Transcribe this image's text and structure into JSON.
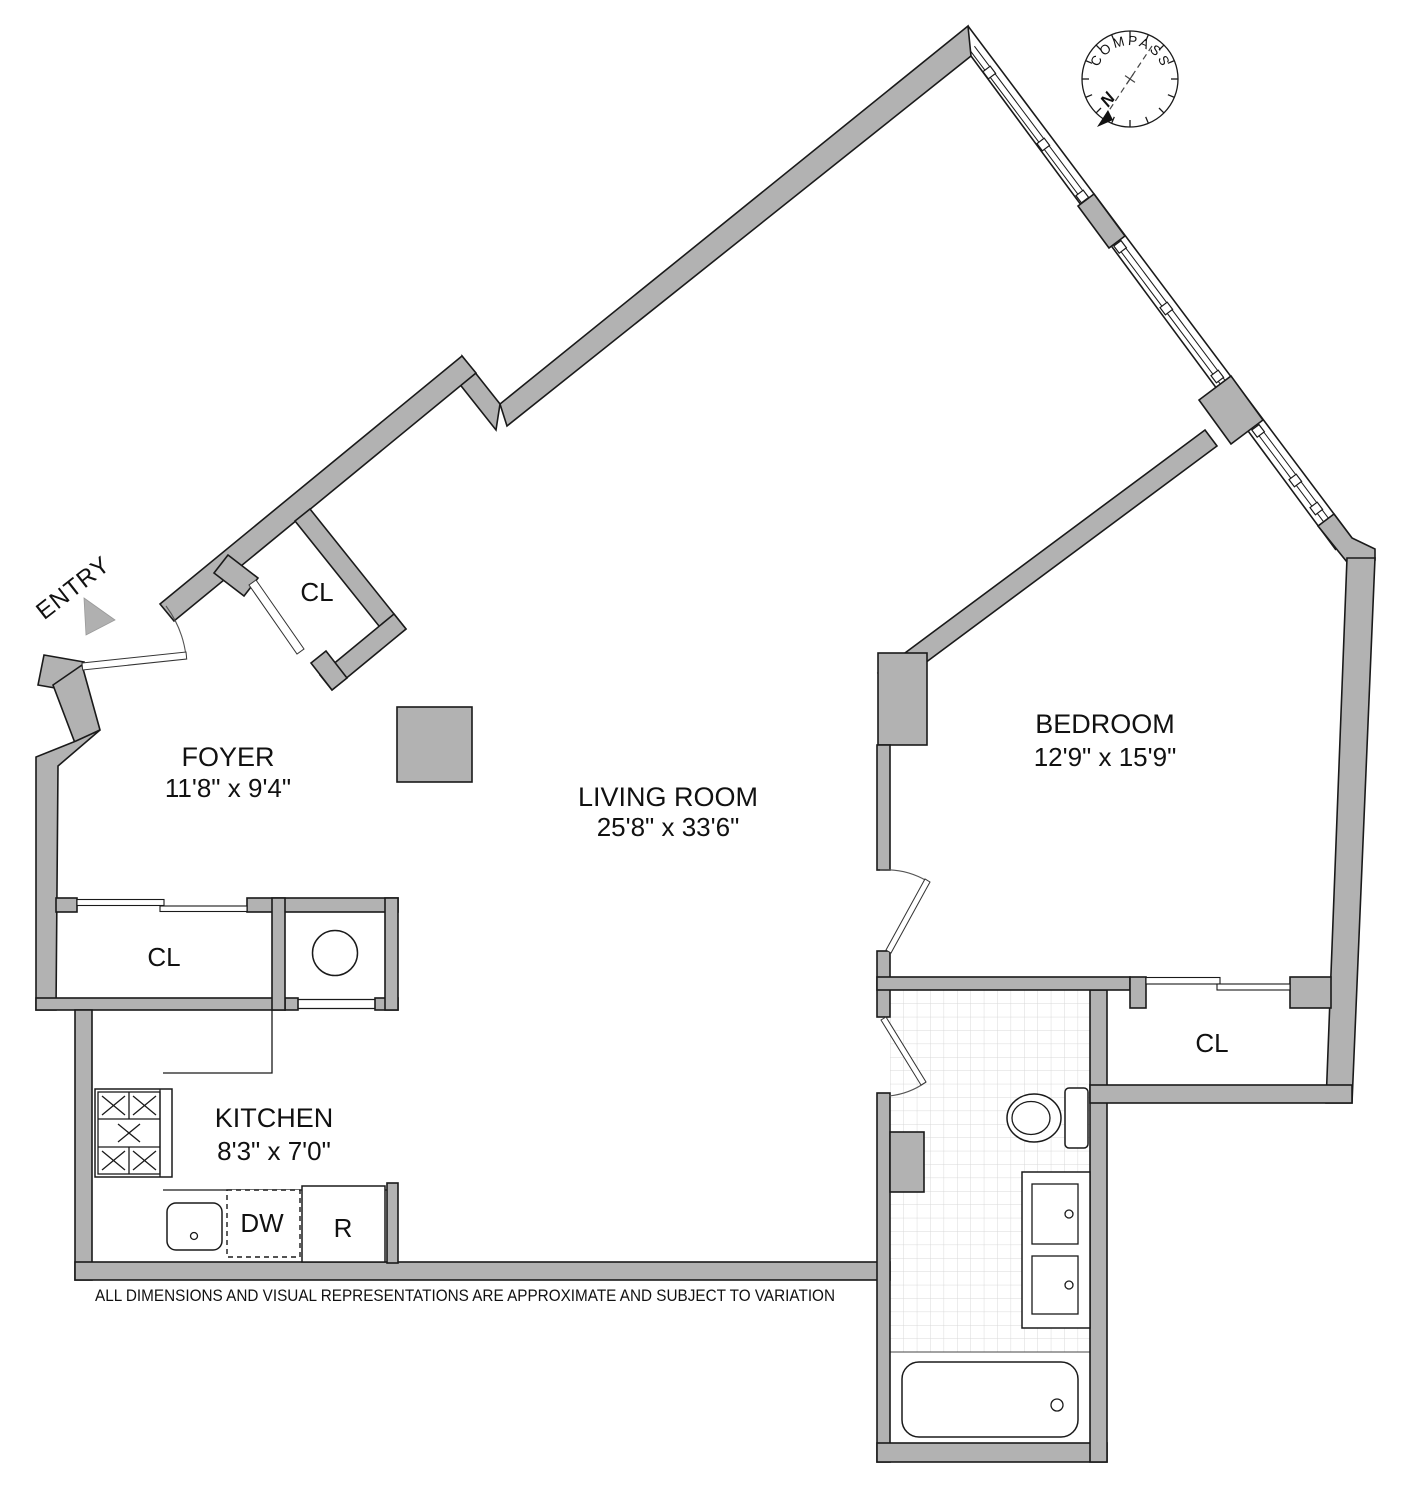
{
  "plan": {
    "rooms": {
      "foyer": {
        "name": "FOYER",
        "dims": "11'8\" x 9'4\""
      },
      "living_room": {
        "name": "LIVING ROOM",
        "dims": "25'8\" x 33'6\""
      },
      "bedroom": {
        "name": "BEDROOM",
        "dims": "12'9\" x 15'9\""
      },
      "kitchen": {
        "name": "KITCHEN",
        "dims": "8'3\" x 7'0\""
      }
    },
    "closets": {
      "foyer_closet": "CL",
      "hall_closet": "CL",
      "bedroom_closet": "CL"
    },
    "appliances": {
      "dishwasher": "DW",
      "refrigerator": "R"
    },
    "entry": {
      "label": "ENTRY"
    },
    "compass": {
      "label": "COMPASS",
      "north": "N"
    },
    "disclaimer": "ALL DIMENSIONS AND VISUAL REPRESENTATIONS ARE APPROXIMATE AND SUBJECT TO VARIATION",
    "colors": {
      "wall_gray": "#b2b2b2",
      "north_red": "#cc1111",
      "line_black": "#1a1a1a",
      "tile_gray": "#d9d9d9"
    }
  }
}
